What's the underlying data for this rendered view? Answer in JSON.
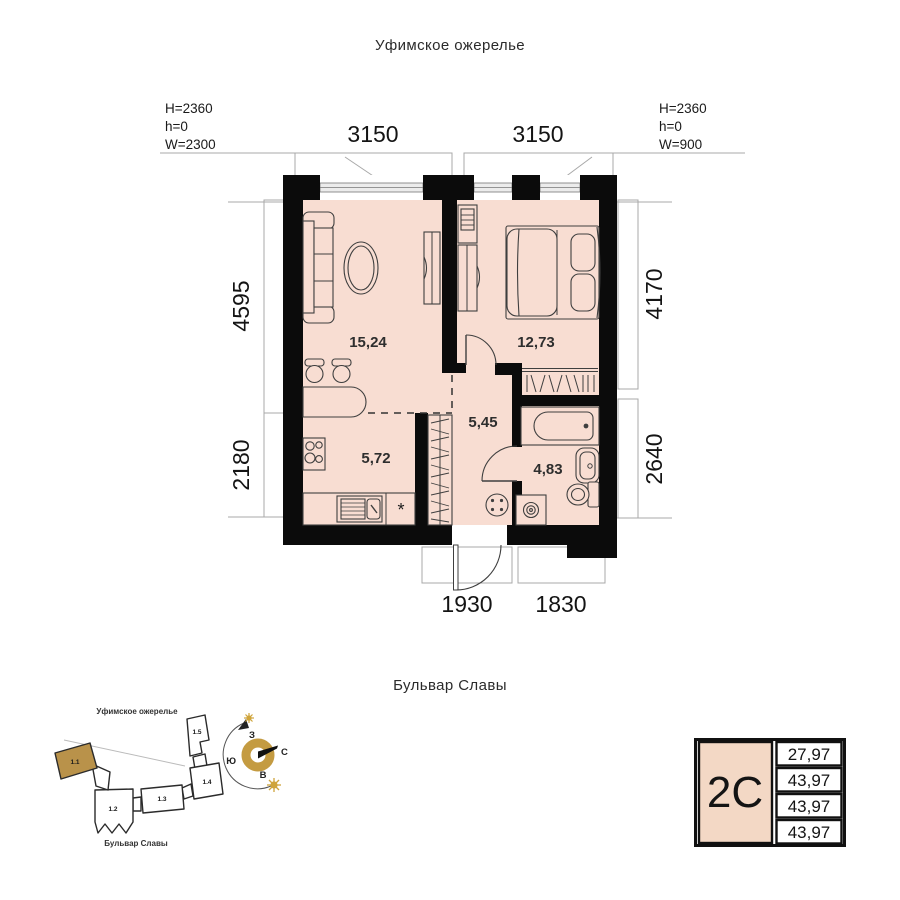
{
  "titles": {
    "top": "Уфимское ожерелье",
    "bottom": "Бульвар Славы"
  },
  "window_specs": {
    "left": [
      "H=2360",
      "h=0",
      "W=2300"
    ],
    "right": [
      "H=2360",
      "h=0",
      "W=900"
    ]
  },
  "dimensions": {
    "top": [
      "3150",
      "3150"
    ],
    "left": [
      "4595",
      "2180"
    ],
    "right": [
      "4170",
      "2640"
    ],
    "bottom": [
      "1930",
      "1830"
    ]
  },
  "rooms": {
    "living": {
      "area": "15,24"
    },
    "bedroom": {
      "area": "12,73"
    },
    "hallway": {
      "area": "5,45"
    },
    "kitchen": {
      "area": "5,72"
    },
    "bathroom": {
      "area": "4,83"
    }
  },
  "site_plan": {
    "district_label": "Уфимское ожерелье",
    "street_label": "Бульвар Славы",
    "buildings": [
      {
        "label": "1.1",
        "highlighted": true
      },
      {
        "label": "1.2",
        "highlighted": false
      },
      {
        "label": "1.3",
        "highlighted": false
      },
      {
        "label": "1.4",
        "highlighted": false
      },
      {
        "label": "1.5",
        "highlighted": false
      }
    ]
  },
  "compass": {
    "north": "С",
    "south": "Ю",
    "east": "В",
    "west": "З"
  },
  "info_table": {
    "type": "2С",
    "values": [
      "27,97",
      "43,97",
      "43,97",
      "43,97"
    ]
  },
  "colors": {
    "floor": "#f8ddd2",
    "wall": "#0b0b0b",
    "gold": "#c49b41",
    "table_cell": "#f3d8c5"
  }
}
